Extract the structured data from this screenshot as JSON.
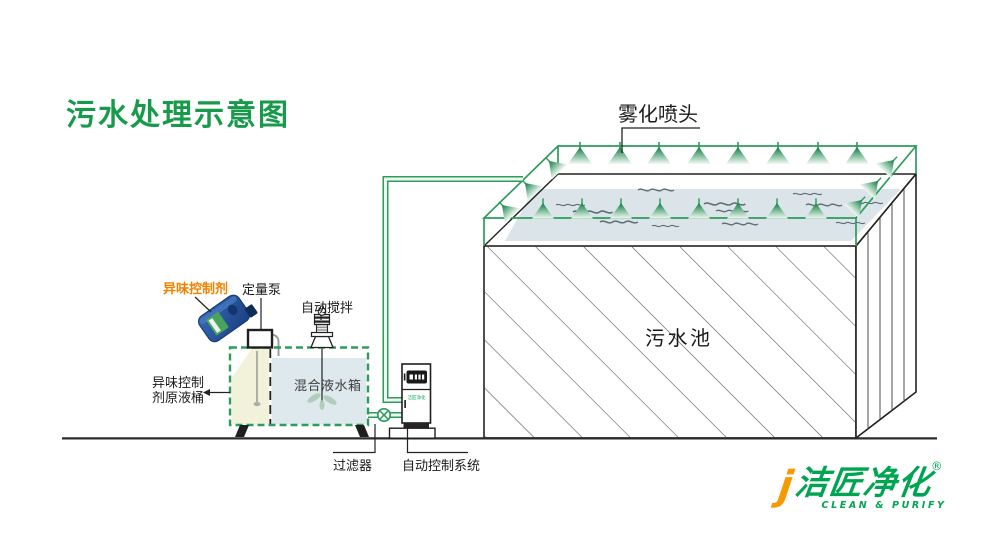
{
  "title": {
    "text": "污水处理示意图",
    "color": "#189A4B"
  },
  "pool": {
    "label": "污水池"
  },
  "spray": {
    "label": "雾化喷头"
  },
  "dosing": {
    "agent_label": "异味控制剂",
    "agent_color": "#F08200",
    "pump_label": "定量泵",
    "stirrer_label": "自动搅拌",
    "tank_label": "混合液水箱",
    "stock_label_line1": "异味控制",
    "stock_label_line2": "剂原液桶"
  },
  "bottom": {
    "filter_label": "过滤器",
    "control_label": "自动控制系统"
  },
  "logo": {
    "j_mark": "j",
    "brand": "洁匠净化",
    "registered": "®",
    "tagline": "CLEAN & PURIFY",
    "green": "#00A551",
    "orange": "#F59A00"
  },
  "colors": {
    "diagram_green": "#2D9C5C",
    "water_surface": "#DBE4E8",
    "tank_left_liquid": "#F2F2DB",
    "tank_right_liquid": "#DDE9ED",
    "line_black": "#222222"
  }
}
